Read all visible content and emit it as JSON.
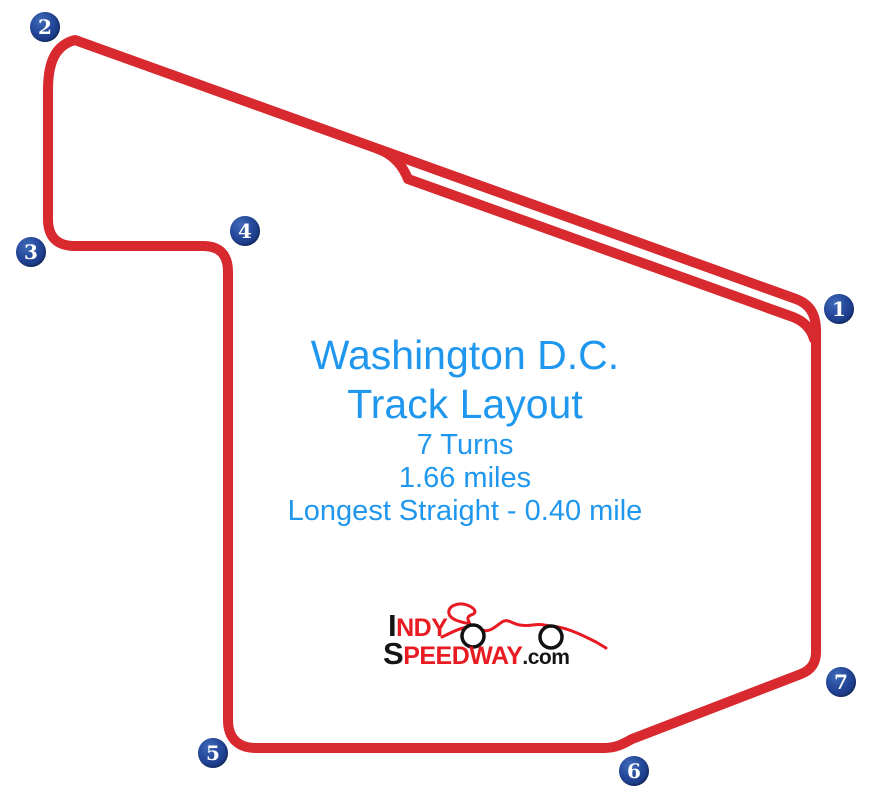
{
  "colors": {
    "track_red": "#d8292f",
    "logo_red": "#e81b23",
    "logo_black": "#151515",
    "marker_navy": "#1b3a85",
    "text_blue": "#1f97ee"
  },
  "title": {
    "line1": "Washington D.C.",
    "line2": "Track Layout"
  },
  "stats": {
    "turns": "7 Turns",
    "length": "1.66 miles",
    "longest_straight": "Longest Straight - 0.40 mile"
  },
  "logo": {
    "indy_first": "I",
    "indy_rest": "NDY",
    "speedway_first": "S",
    "speedway_rest": "PEEDWAY",
    "suffix": ".com"
  },
  "turns": [
    {
      "number": "1",
      "x": 839,
      "y": 309
    },
    {
      "number": "2",
      "x": 45,
      "y": 27
    },
    {
      "number": "3",
      "x": 31,
      "y": 252
    },
    {
      "number": "4",
      "x": 245,
      "y": 231
    },
    {
      "number": "5",
      "x": 213,
      "y": 753
    },
    {
      "number": "6",
      "x": 634,
      "y": 771
    },
    {
      "number": "7",
      "x": 841,
      "y": 682
    }
  ]
}
